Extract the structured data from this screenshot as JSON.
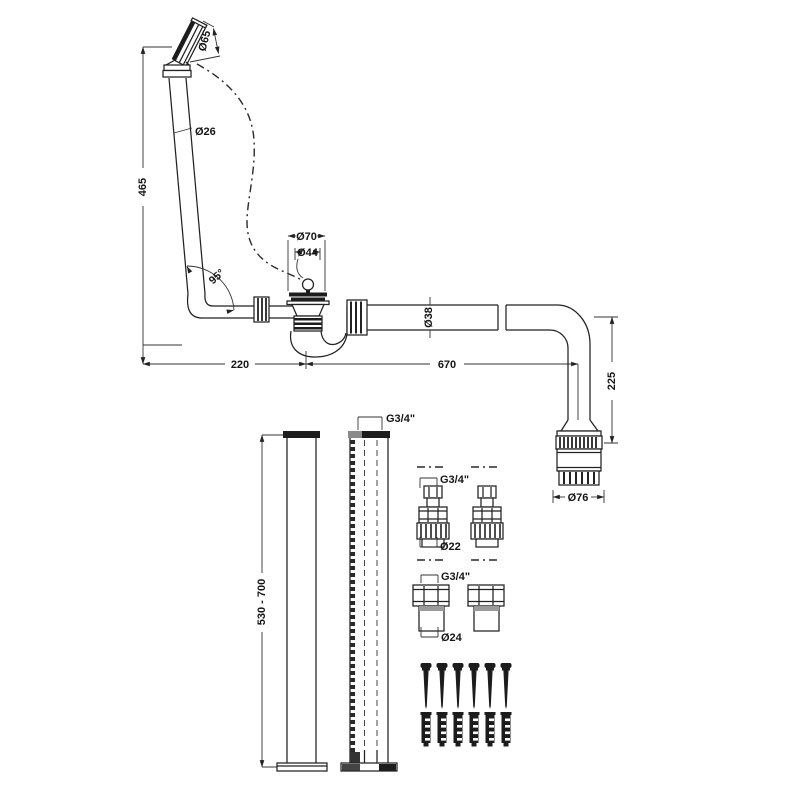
{
  "drawing": {
    "labels": {
      "overflow_height": "465",
      "overflow_face_diameter": "Ø65",
      "overflow_pipe_diameter": "Ø26",
      "elbow_angle": "95°",
      "waste_flange_diameter": "Ø70",
      "plug_diameter": "Ø44",
      "waste_pipe_diameter": "Ø38",
      "dim_waste_offset": "220",
      "dim_pipe_run": "670",
      "dim_drop": "225",
      "trap_connector_diameter": "Ø76",
      "standpipe_height": "530 - 700",
      "standpipe_thread": "G3/4\"",
      "union_thread": "G3/4\"",
      "union_pipe_diameter": "Ø22",
      "coupler_thread": "G3/4\"",
      "coupler_pipe_diameter": "Ø24"
    },
    "colors": {
      "line": "#222222",
      "dark_fill": "#1c1c1c",
      "background": "#ffffff"
    }
  }
}
